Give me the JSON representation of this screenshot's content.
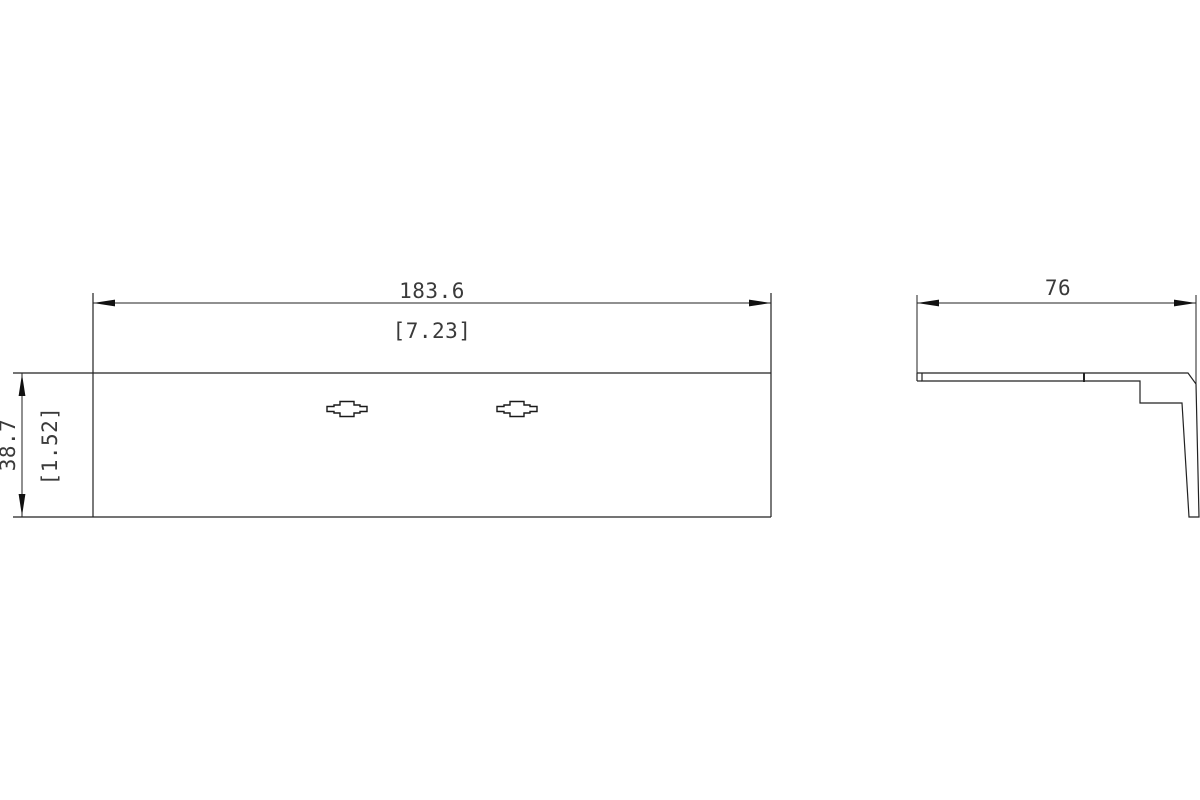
{
  "drawing": {
    "type": "technical-dimension-drawing",
    "views": {
      "front_view": {
        "width_dim_mm": "183.6",
        "width_dim_in": "[7.23]",
        "height_dim_mm": "38.7",
        "height_dim_in": "[1.52]"
      },
      "side_view": {
        "depth_dim_mm": "76"
      }
    },
    "colors": {
      "line": "#222222",
      "arrow": "#111111",
      "text": "#3a3a3a",
      "background": "#ffffff"
    }
  }
}
